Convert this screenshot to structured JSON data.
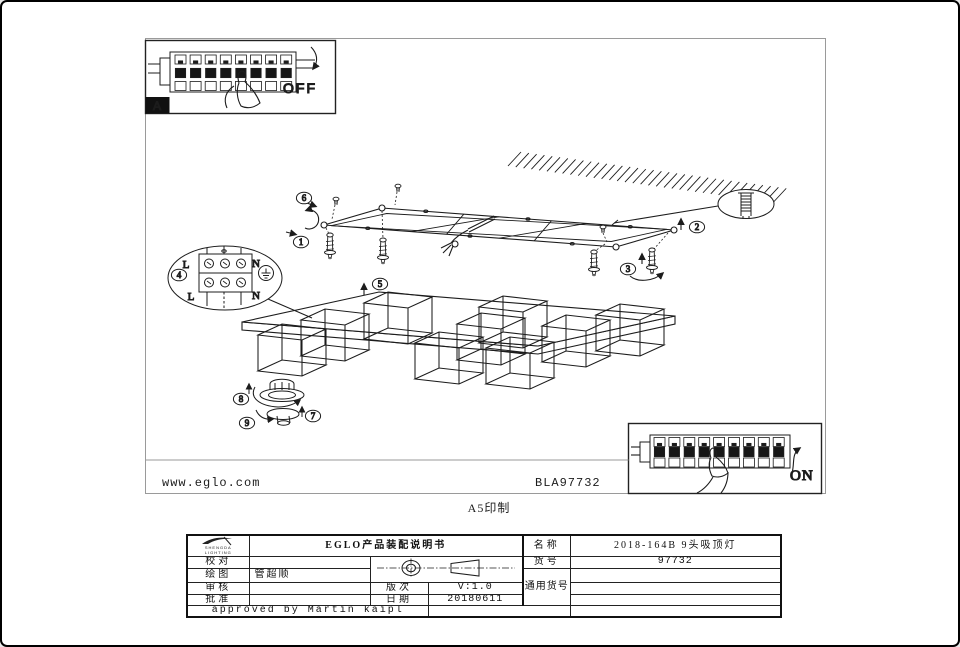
{
  "page": {
    "print_note": "A5印制"
  },
  "insets": {
    "off": {
      "label": "OFF",
      "badge": "A"
    },
    "on": {
      "label": "ON"
    }
  },
  "terminal_detail": {
    "l_top": "L",
    "n_top": "N",
    "l_bottom": "L",
    "n_bottom": "N"
  },
  "callouts": {
    "c1": "1",
    "c2": "2",
    "c3": "3",
    "c4": "4",
    "c5": "5",
    "c6": "6",
    "c7": "7",
    "c8": "8",
    "c9": "9"
  },
  "footer": {
    "website": "www.eglo.com",
    "code": "BLA97732"
  },
  "title_block": {
    "logo_text": "SHENGDA LIGHTING",
    "doc_title": "EGLO产品装配说明书",
    "check_label": "校对",
    "draw_label": "绘图",
    "draw_value": "管超顺",
    "review_label": "审核",
    "approve_label": "批准",
    "version_label": "版次",
    "version_value": "V:1.0",
    "date_label": "日期",
    "date_value": "20180611",
    "name_label": "名称",
    "name_value": "2018-164B 9头吸顶灯",
    "item_label": "货号",
    "item_value": "97732",
    "common_label": "通用货号",
    "approved_note": "approved by Martin kaipl"
  },
  "colors": {
    "line": "#1c1c1c",
    "frame": "#9a9a9a",
    "table_line": "#111111"
  }
}
